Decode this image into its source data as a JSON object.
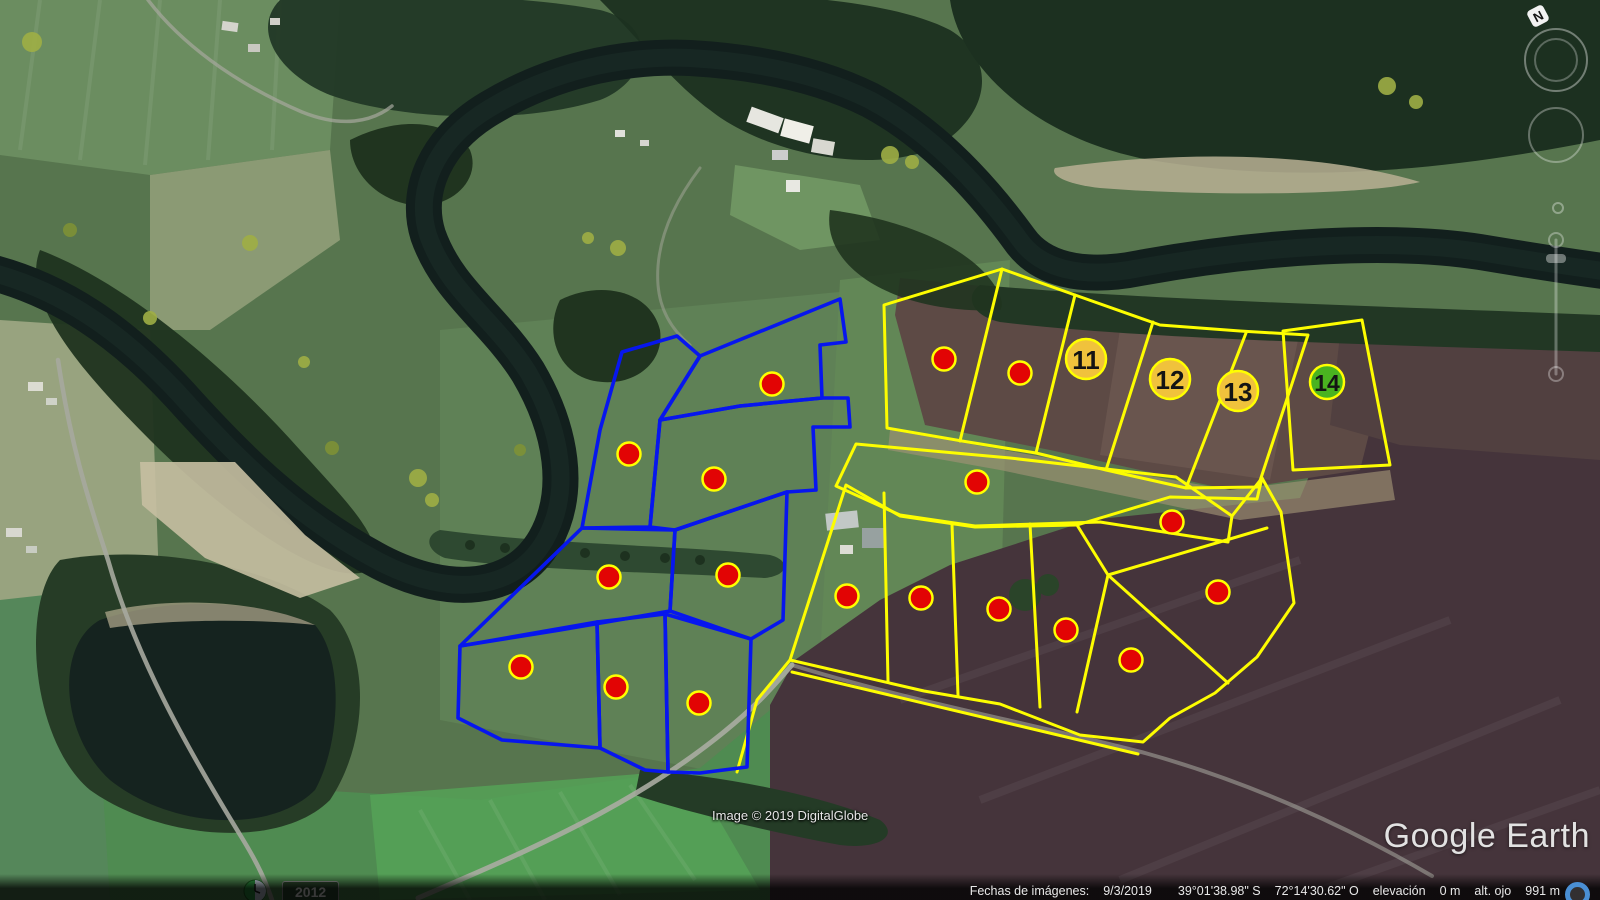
{
  "app": {
    "logo_text": "Google Earth"
  },
  "attribution": {
    "imagery": "Image © 2019 DigitalGlobe"
  },
  "status_bar": {
    "dates_label": "Fechas de imágenes:",
    "date": "9/3/2019",
    "latitude": "39°01'38.98\" S",
    "longitude": "72°14'30.62\" O",
    "elevation_label": "elevación",
    "elevation_value": "0 m",
    "eye_alt_label": "alt. ojo",
    "eye_alt_value": "991 m"
  },
  "time_slider": {
    "year": "2012"
  },
  "compass": {
    "north_label": "N"
  },
  "colors": {
    "parcel_blue": "#0716ee",
    "parcel_yellow": "#fdfd00",
    "marker_fill": "#e20404",
    "marker_stroke": "#ffff00",
    "badge_gold": "#f0c23c",
    "badge_green": "#4ab320",
    "badge_text": "#141414",
    "streaming_indicator": "#4a8fd4"
  },
  "map_overlay": {
    "marker_radius": 11.5,
    "blue_parcels": [
      [
        [
          622,
          352
        ],
        [
          677,
          336
        ],
        [
          700,
          356
        ],
        [
          660,
          420
        ],
        [
          650,
          527
        ],
        [
          582,
          528
        ],
        [
          600,
          430
        ]
      ],
      [
        [
          700,
          356
        ],
        [
          840,
          299
        ],
        [
          846,
          342
        ],
        [
          820,
          345
        ],
        [
          822,
          398
        ],
        [
          740,
          406
        ],
        [
          660,
          420
        ]
      ],
      [
        [
          660,
          420
        ],
        [
          740,
          406
        ],
        [
          822,
          398
        ],
        [
          848,
          398
        ],
        [
          850,
          427
        ],
        [
          813,
          427
        ],
        [
          816,
          490
        ],
        [
          787,
          492
        ],
        [
          675,
          530
        ],
        [
          650,
          527
        ]
      ],
      [
        [
          675,
          530
        ],
        [
          787,
          492
        ],
        [
          783,
          620
        ],
        [
          751,
          639
        ],
        [
          670,
          611
        ]
      ],
      [
        [
          582,
          528
        ],
        [
          675,
          530
        ],
        [
          670,
          611
        ],
        [
          560,
          630
        ],
        [
          460,
          646
        ]
      ],
      [
        [
          460,
          646
        ],
        [
          597,
          622
        ],
        [
          600,
          748
        ],
        [
          502,
          740
        ],
        [
          458,
          718
        ]
      ],
      [
        [
          597,
          622
        ],
        [
          665,
          614
        ],
        [
          668,
          772
        ],
        [
          645,
          770
        ],
        [
          600,
          748
        ]
      ],
      [
        [
          665,
          614
        ],
        [
          751,
          639
        ],
        [
          747,
          767
        ],
        [
          700,
          773
        ],
        [
          668,
          772
        ]
      ]
    ],
    "yellow_parcels": [
      [
        [
          884,
          305
        ],
        [
          1002,
          269
        ],
        [
          1075,
          295
        ],
        [
          1160,
          325
        ],
        [
          1240,
          331
        ],
        [
          1308,
          335
        ],
        [
          1258,
          487
        ],
        [
          1186,
          488
        ],
        [
          1106,
          470
        ],
        [
          1036,
          453
        ],
        [
          962,
          441
        ],
        [
          887,
          428
        ]
      ],
      [
        [
          1283,
          331
        ],
        [
          1362,
          320
        ],
        [
          1390,
          465
        ],
        [
          1293,
          470
        ]
      ],
      [
        [
          856,
          444
        ],
        [
          1010,
          458
        ],
        [
          1176,
          477
        ],
        [
          1232,
          516
        ],
        [
          1228,
          542
        ],
        [
          1100,
          522
        ],
        [
          975,
          526
        ],
        [
          900,
          515
        ],
        [
          836,
          486
        ]
      ],
      [
        [
          846,
          485
        ],
        [
          900,
          516
        ],
        [
          975,
          527
        ],
        [
          1077,
          525
        ],
        [
          1170,
          497
        ],
        [
          1257,
          499
        ],
        [
          1262,
          478
        ],
        [
          1281,
          512
        ],
        [
          1294,
          603
        ],
        [
          1257,
          657
        ],
        [
          1215,
          693
        ],
        [
          1170,
          718
        ],
        [
          1143,
          742
        ],
        [
          1080,
          735
        ],
        [
          1000,
          704
        ],
        [
          924,
          691
        ],
        [
          790,
          660
        ]
      ]
    ],
    "yellow_lines": [
      [
        [
          1002,
          269
        ],
        [
          960,
          441
        ]
      ],
      [
        [
          1075,
          295
        ],
        [
          1036,
          453
        ]
      ],
      [
        [
          1153,
          322
        ],
        [
          1106,
          470
        ]
      ],
      [
        [
          1246,
          333
        ],
        [
          1186,
          488
        ]
      ],
      [
        [
          884,
          493
        ],
        [
          888,
          681
        ]
      ],
      [
        [
          952,
          524
        ],
        [
          958,
          695
        ]
      ],
      [
        [
          1030,
          524
        ],
        [
          1040,
          707
        ]
      ],
      [
        [
          1077,
          525
        ],
        [
          1108,
          575
        ],
        [
          1077,
          712
        ]
      ],
      [
        [
          1108,
          575
        ],
        [
          1267,
          528
        ]
      ],
      [
        [
          1108,
          575
        ],
        [
          1228,
          683
        ]
      ],
      [
        [
          792,
          672
        ],
        [
          1138,
          754
        ]
      ],
      [
        [
          790,
          660
        ],
        [
          757,
          700
        ],
        [
          737,
          772
        ]
      ],
      [
        [
          1232,
          516
        ],
        [
          1262,
          478
        ]
      ]
    ],
    "markers": [
      [
        772,
        384
      ],
      [
        629,
        454
      ],
      [
        714,
        479
      ],
      [
        609,
        577
      ],
      [
        728,
        575
      ],
      [
        521,
        667
      ],
      [
        616,
        687
      ],
      [
        699,
        703
      ],
      [
        944,
        359
      ],
      [
        1020,
        373
      ],
      [
        977,
        482
      ],
      [
        847,
        596
      ],
      [
        921,
        598
      ],
      [
        999,
        609
      ],
      [
        1066,
        630
      ],
      [
        1131,
        660
      ],
      [
        1172,
        522
      ],
      [
        1218,
        592
      ]
    ],
    "badges": [
      {
        "x": 1086,
        "y": 359,
        "r": 20,
        "label": "11",
        "color": "#f0c23c"
      },
      {
        "x": 1170,
        "y": 379,
        "r": 20,
        "label": "12",
        "color": "#f0c23c"
      },
      {
        "x": 1238,
        "y": 391,
        "r": 20,
        "label": "13",
        "color": "#f0c23c"
      },
      {
        "x": 1327,
        "y": 382,
        "r": 17,
        "label": "14",
        "color": "#4ab320"
      }
    ]
  }
}
